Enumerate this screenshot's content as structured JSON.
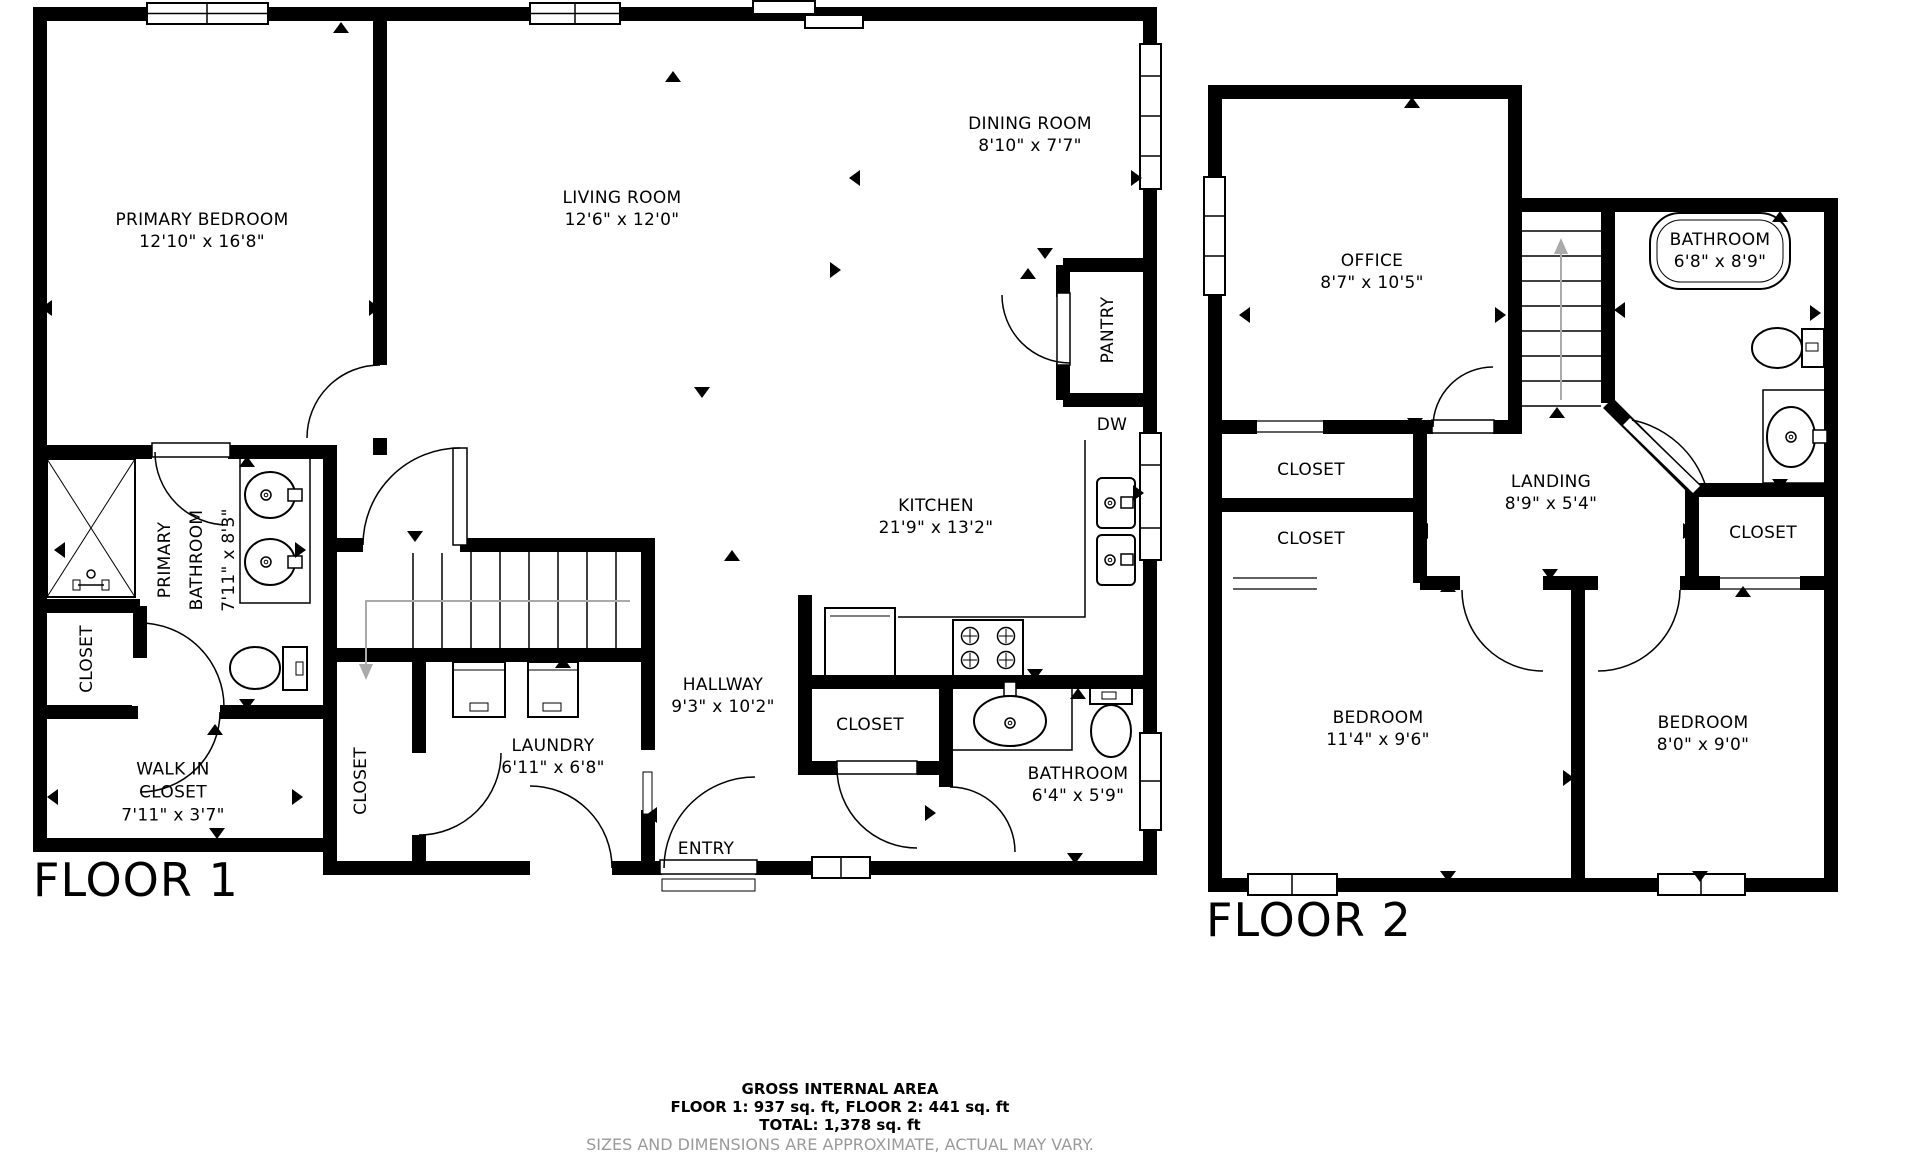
{
  "floor1": {
    "title": "FLOOR 1",
    "rooms": {
      "primary_bedroom": {
        "name": "PRIMARY BEDROOM",
        "dims": "12'10\" x 16'8\""
      },
      "living_room": {
        "name": "LIVING ROOM",
        "dims": "12'6\" x 12'0\""
      },
      "dining_room": {
        "name": "DINING ROOM",
        "dims": "8'10\" x 7'7\""
      },
      "kitchen": {
        "name": "KITCHEN",
        "dims": "21'9\" x 13'2\""
      },
      "pantry": {
        "name": "PANTRY"
      },
      "dw": {
        "name": "DW"
      },
      "primary_bathroom": {
        "name_line1": "PRIMARY",
        "name_line2": "BATHROOM",
        "dims": "7'11\" x 8'3\""
      },
      "closet_left": {
        "name": "CLOSET"
      },
      "walk_in_closet": {
        "name_line1": "WALK IN",
        "name_line2": "CLOSET",
        "dims": "7'11\" x 3'7\""
      },
      "closet_mid": {
        "name": "CLOSET"
      },
      "laundry": {
        "name": "LAUNDRY",
        "dims": "6'11\" x 6'8\""
      },
      "hallway": {
        "name": "HALLWAY",
        "dims": "9'3\" x 10'2\""
      },
      "closet_hall": {
        "name": "CLOSET"
      },
      "entry": {
        "name": "ENTRY"
      },
      "bathroom": {
        "name": "BATHROOM",
        "dims": "6'4\" x 5'9\""
      }
    }
  },
  "floor2": {
    "title": "FLOOR 2",
    "rooms": {
      "office": {
        "name": "OFFICE",
        "dims": "8'7\" x 10'5\""
      },
      "bathroom": {
        "name": "BATHROOM",
        "dims": "6'8\" x 8'9\""
      },
      "closet_top": {
        "name": "CLOSET"
      },
      "closet_bottom": {
        "name": "CLOSET"
      },
      "closet_right": {
        "name": "CLOSET"
      },
      "landing": {
        "name": "LANDING",
        "dims": "8'9\" x 5'4\""
      },
      "bedroom_left": {
        "name": "BEDROOM",
        "dims": "11'4\" x 9'6\""
      },
      "bedroom_right": {
        "name": "BEDROOM",
        "dims": "8'0\" x 9'0\""
      }
    }
  },
  "footer": {
    "title": "GROSS INTERNAL AREA",
    "areas": "FLOOR 1: 937 sq. ft, FLOOR 2: 441 sq. ft",
    "total": "TOTAL: 1,378 sq. ft",
    "disclaimer": "SIZES AND DIMENSIONS ARE APPROXIMATE, ACTUAL MAY VARY."
  }
}
